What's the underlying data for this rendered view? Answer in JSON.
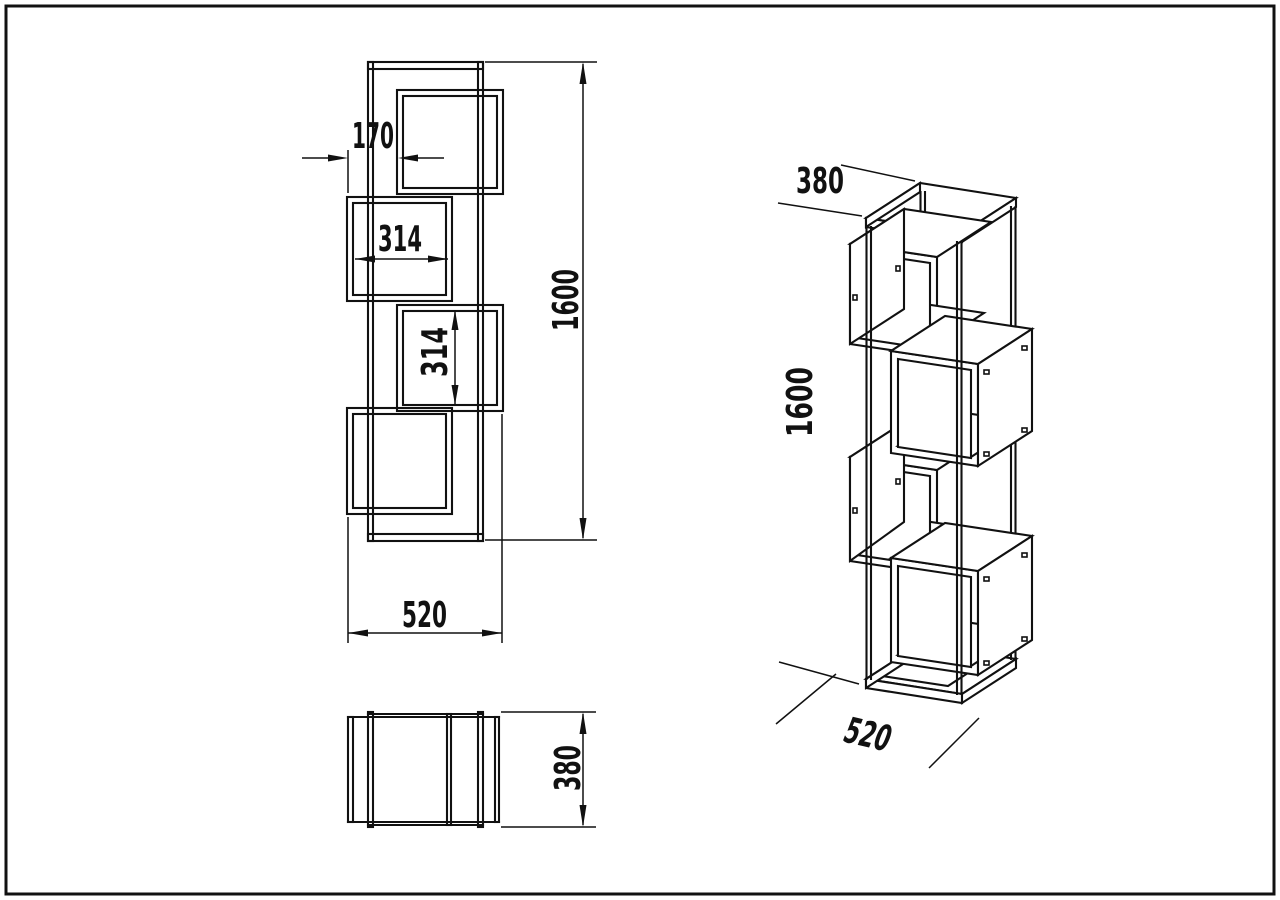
{
  "drawing": {
    "background": "#ffffff",
    "line_color": "#111111",
    "views": {
      "front_view": {
        "dims": {
          "side_offset": "170",
          "box_inner_width": "314",
          "box_inner_height": "314",
          "overall_height": "1600",
          "overall_width": "520"
        }
      },
      "top_view": {
        "dims": {
          "overall_depth": "380"
        }
      },
      "isometric_view": {
        "dims": {
          "overall_depth": "380",
          "overall_height": "1600",
          "overall_width": "520"
        }
      }
    }
  }
}
